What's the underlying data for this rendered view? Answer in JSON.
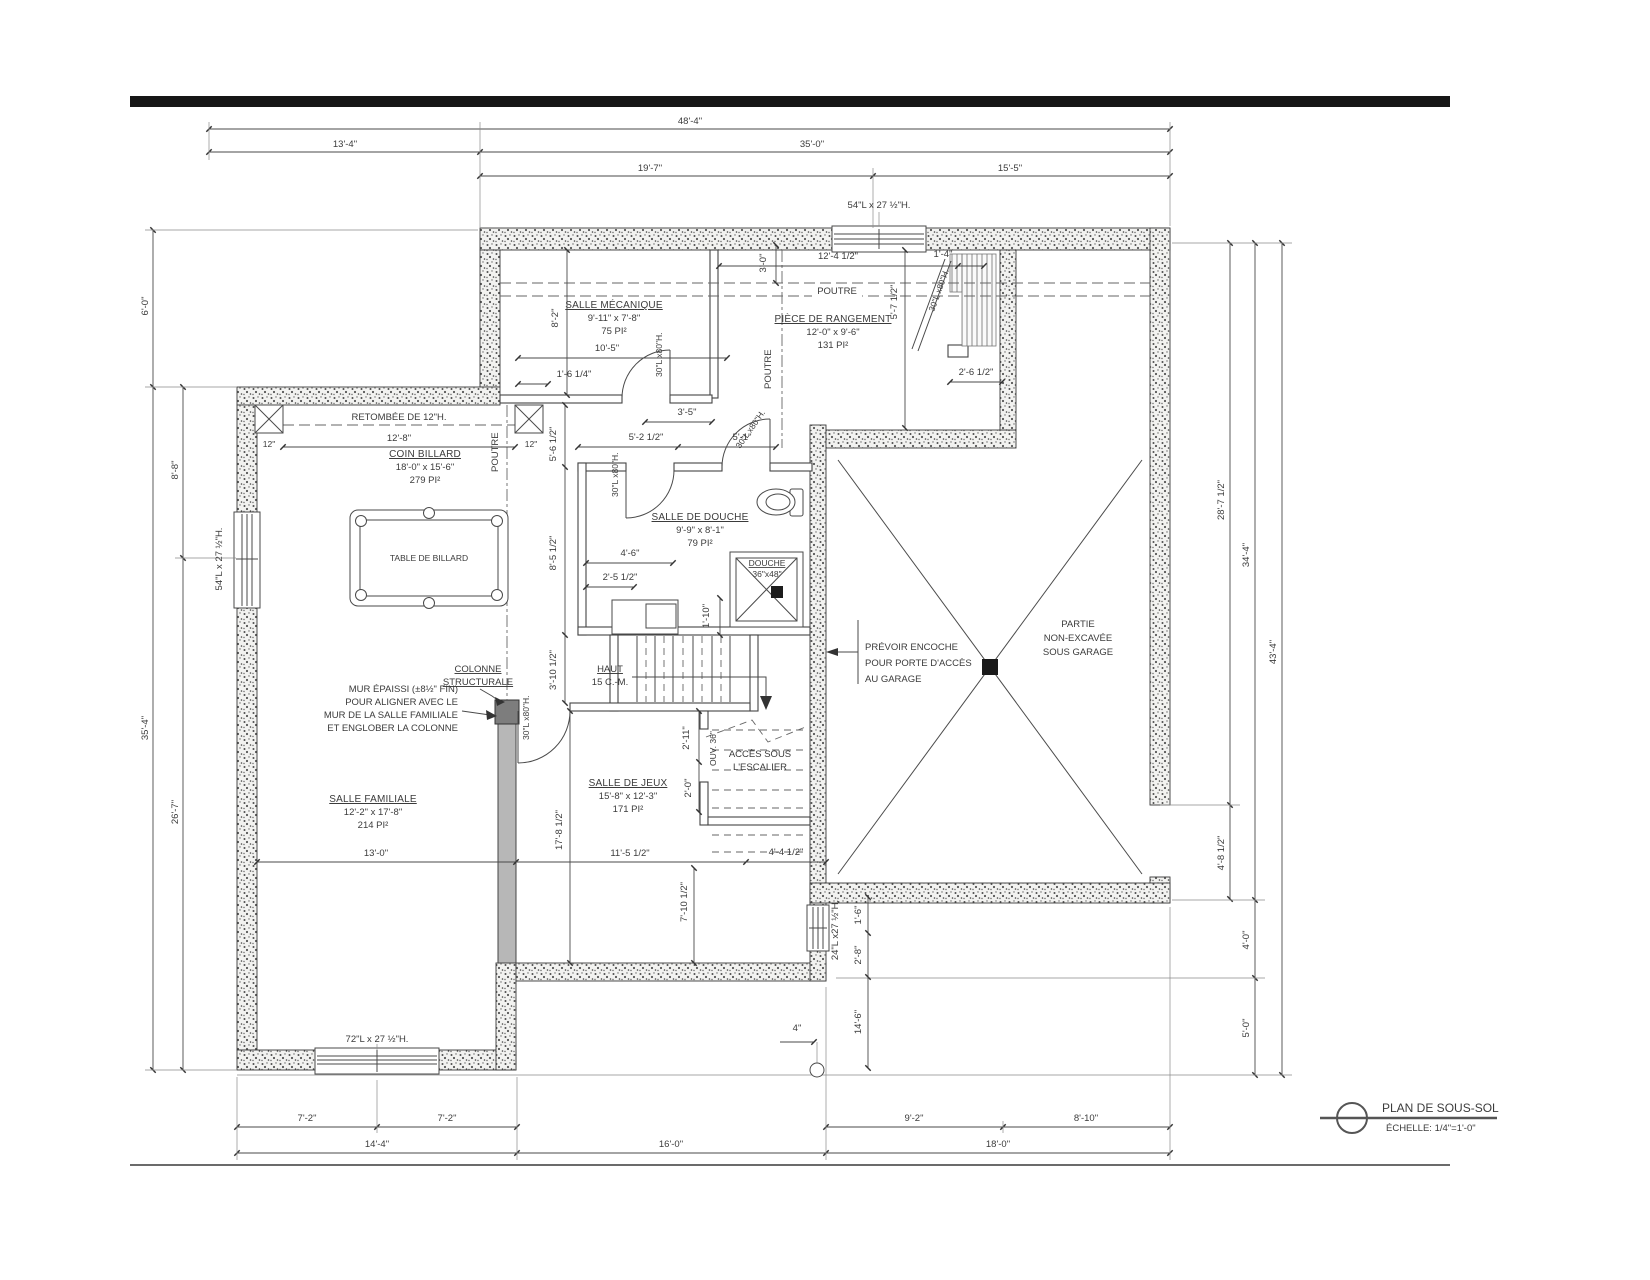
{
  "meta": {
    "title": "PLAN DE SOUS-SOL",
    "scale_label": "ÉCHELLE: 1/4\"=1'-0\""
  },
  "rooms": {
    "mecanique": {
      "name": "SALLE MÉCANIQUE",
      "dims": "9'-11\" x 7'-8\"",
      "area": "75 PI²"
    },
    "rangement": {
      "name": "PIÈCE DE RANGEMENT",
      "dims": "12'-0\" x 9'-6\"",
      "area": "131 PI²"
    },
    "billard": {
      "name": "COIN BILLARD",
      "dims": "18'-0\" x 15'-6\"",
      "area": "279 PI²"
    },
    "douche": {
      "name": "SALLE DE DOUCHE",
      "dims": "9'-9\" x 8'-1\"",
      "area": "79 PI²"
    },
    "familiale": {
      "name": "SALLE FAMILIALE",
      "dims": "12'-2\" x 17'-8\"",
      "area": "214 PI²"
    },
    "jeux": {
      "name": "SALLE DE JEUX",
      "dims": "15'-8\" x 12'-3\"",
      "area": "171 PI²"
    }
  },
  "labels": {
    "partie1": "PARTIE",
    "partie2": "NON-EXCAVÉE",
    "partie3": "SOUS GARAGE",
    "prevoir1": "PRÉVOIR ENCOCHE",
    "prevoir2": "POUR PORTE D'ACCÈS",
    "prevoir3": "AU GARAGE",
    "mur1": "MUR ÉPAISSI (±8½\" FIN)",
    "mur2": "POUR ALIGNER AVEC LE",
    "mur3": "MUR DE LA SALLE FAMILIALE",
    "mur4": "ET ENGLOBER LA COLONNE",
    "colonne1": "COLONNE",
    "colonne2": "STRUCTURALE",
    "acces1": "ACCÈS SOUS",
    "acces2": "L'ESCALIER",
    "haut": "HAUT",
    "haut2": "15 C.-M.",
    "retombee": "RETOMBÉE DE 12\"H.",
    "table_billard": "TABLE DE BILLARD",
    "douche_label": "DOUCHE",
    "douche_size": "36\"x48\"",
    "poutre": "POUTRE",
    "ouv": "OUV. 36\""
  },
  "openings": {
    "win54": "54\"L x 27 ½\"H.",
    "win72": "72\"L x 27 ½\"H.",
    "win24": "24\"L x27 ½\"H.",
    "door30": "30\"L x80\"H."
  },
  "dims": {
    "top": {
      "d48": "48'-4\"",
      "d13": "13'-4\"",
      "d35": "35'-0\"",
      "d19": "19'-7\"",
      "d15": "15'-5\""
    },
    "left": {
      "d6": "6'-0\"",
      "d8": "8'-8\"",
      "d35": "35'-4\"",
      "d26": "26'-7\""
    },
    "right": {
      "d28": "28'-7 1/2\"",
      "d34": "34'-4\"",
      "d43": "43'-4\"",
      "d485": "4'-8 1/2\"",
      "d4": "4'-0\"",
      "d5": "5'-0\""
    },
    "bottom": {
      "d72a": "7'-2\"",
      "d72b": "7'-2\"",
      "d144": "14'-4\"",
      "d160": "16'-0\"",
      "d180": "18'-0\"",
      "d92": "9'-2\"",
      "d810": "8'-10\""
    },
    "inner": {
      "i124": "12'-4 1/2\"",
      "i30": "3'-0\"",
      "i14": "1'-4\"",
      "i57": "5'-7 1/2\"",
      "i26": "2'-6 1/2\"",
      "i105": "10'-5\"",
      "i164": "1'-6 1/4\"",
      "i82": "8'-2\"",
      "i35": "3'-5\"",
      "i52": "5'-2 1/2\"",
      "i51": "5'-1\"",
      "i128": "12'-8\"",
      "i12": "12\"",
      "i56": "5'-6 1/2\"",
      "i85": "8'-5 1/2\"",
      "i310": "3'-10 1/2\"",
      "i46": "4'-6\"",
      "i25": "2'-5 1/2\"",
      "i110": "1'-10\"",
      "i211": "2'-11\"",
      "i20": "2'-0\"",
      "i130": "13'-0\"",
      "i115": "11'-5 1/2\"",
      "i178": "17'-8 1/2\"",
      "i710": "7'-10 1/2\"",
      "i44": "4'-4 1/2\"",
      "i16": "1'-6\"",
      "i28": "2'-8\"",
      "i146": "14'-6\"",
      "i4": "4\""
    }
  }
}
